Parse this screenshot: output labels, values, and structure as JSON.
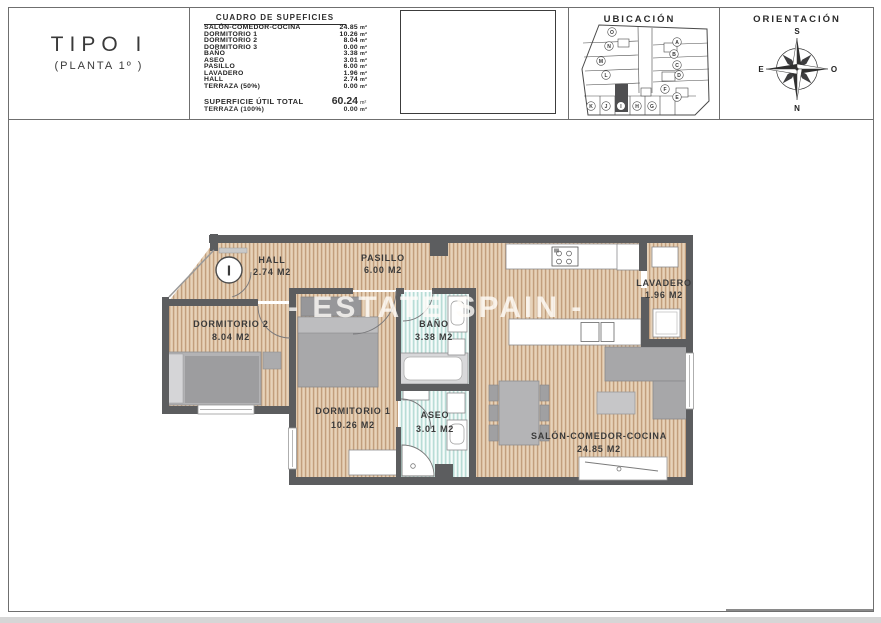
{
  "title_block": {
    "tipo": "TIPO I",
    "planta": "(PLANTA 1º )"
  },
  "surface_table": {
    "header": "CUADRO DE SUPEFICIES",
    "unit": "m²",
    "rows": [
      {
        "label": "SALÓN-COMEDOR-COCINA",
        "value": "24.85"
      },
      {
        "label": "DORMITORIO 1",
        "value": "10.26"
      },
      {
        "label": "DORMITORIO 2",
        "value": "8.04"
      },
      {
        "label": "DORMITORIO 3",
        "value": "0.00"
      },
      {
        "label": "BAÑO",
        "value": "3.38"
      },
      {
        "label": "ASEO",
        "value": "3.01"
      },
      {
        "label": "PASILLO",
        "value": "6.00"
      },
      {
        "label": "LAVADERO",
        "value": "1.96"
      },
      {
        "label": "HALL",
        "value": "2.74"
      },
      {
        "label": "TERRAZA (50%)",
        "value": "0.00"
      }
    ],
    "total": {
      "label": "SUPERFICIE ÚTIL TOTAL",
      "value": "60.24"
    },
    "terraza_total": {
      "label": "TERRAZA (100%)",
      "value": "0.00"
    }
  },
  "ubicacion": {
    "title": "UBICACIÓN",
    "units": [
      "A",
      "B",
      "C",
      "D",
      "E",
      "F",
      "G",
      "H",
      "I",
      "J",
      "K",
      "L",
      "M",
      "N",
      "O"
    ],
    "highlighted_unit": "I"
  },
  "orientacion": {
    "title": "ORIENTACIÓN",
    "points": {
      "top": "S",
      "bottom": "N",
      "left": "E",
      "right": "O"
    }
  },
  "floor_plan": {
    "unit_marker": "I",
    "rooms": [
      {
        "name": "HALL",
        "area": "2.74 M2"
      },
      {
        "name": "PASILLO",
        "area": "6.00 M2"
      },
      {
        "name": "DORMITORIO 2",
        "area": "8.04 M2"
      },
      {
        "name": "BAÑO",
        "area": "3.38 M2"
      },
      {
        "name": "DORMITORIO 1",
        "area": "10.26 M2"
      },
      {
        "name": "ASEO",
        "area": "3.01 M2"
      },
      {
        "name": "LAVADERO",
        "area": "1.96 M2"
      },
      {
        "name": "SALÓN-COMEDOR-COCINA",
        "area": "24.85 M2"
      }
    ]
  },
  "watermark": "- ESTATE SPAIN -",
  "colors": {
    "wood_floor": "#dcc1a3",
    "wood_stripe": "#c19e7d",
    "bath_floor": "#d6ece8",
    "wall": "#5c5d5f",
    "furniture": "#a8a8aa",
    "label_text": "#3b3b3b"
  }
}
